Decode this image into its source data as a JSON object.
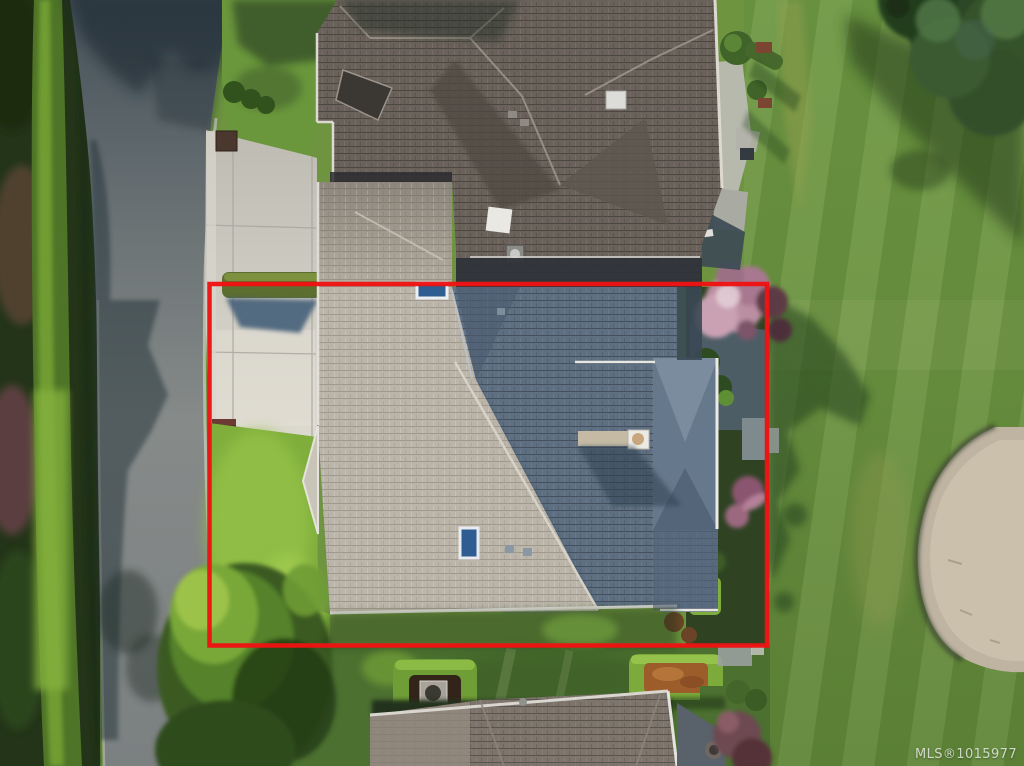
{
  "watermark": {
    "text": "MLS®1015977"
  },
  "annotation": {
    "type": "property-boundary-outline",
    "color": "#ee1313"
  },
  "scene": {
    "kind": "aerial-drone-photo",
    "subject": "house-lot-outlined-in-red-next-to-golf-fairway-and-sand-bunker",
    "elements": [
      "street",
      "roadside-hedge",
      "driveway",
      "clipped-hedge",
      "subject-house-roof",
      "neighbor-house-roofs",
      "front-lawn",
      "backyard-garden",
      "pink-blossom-tree",
      "golf-fairway",
      "sand-bunker",
      "large-tree",
      "garden-hedge-rings"
    ]
  },
  "palette": {
    "boundary_red": "#ee1313",
    "lawn_bright": "#8fbf3e",
    "lawn_mid": "#6d9440",
    "lawn_shadow": "#2f4d22",
    "road_asphalt": "#7b8081",
    "road_shadow": "#35434c",
    "concrete": "#cdcac1",
    "roof_dark": "#6a625a",
    "roof_sunlit": "#bbb5a9",
    "roof_blue": "#5e6f82",
    "skylight_blue": "#2e5d92",
    "sand": "#bfb4a2",
    "hedge_green": "#5c6e30",
    "blossom_pink": "#bb8fa2"
  }
}
